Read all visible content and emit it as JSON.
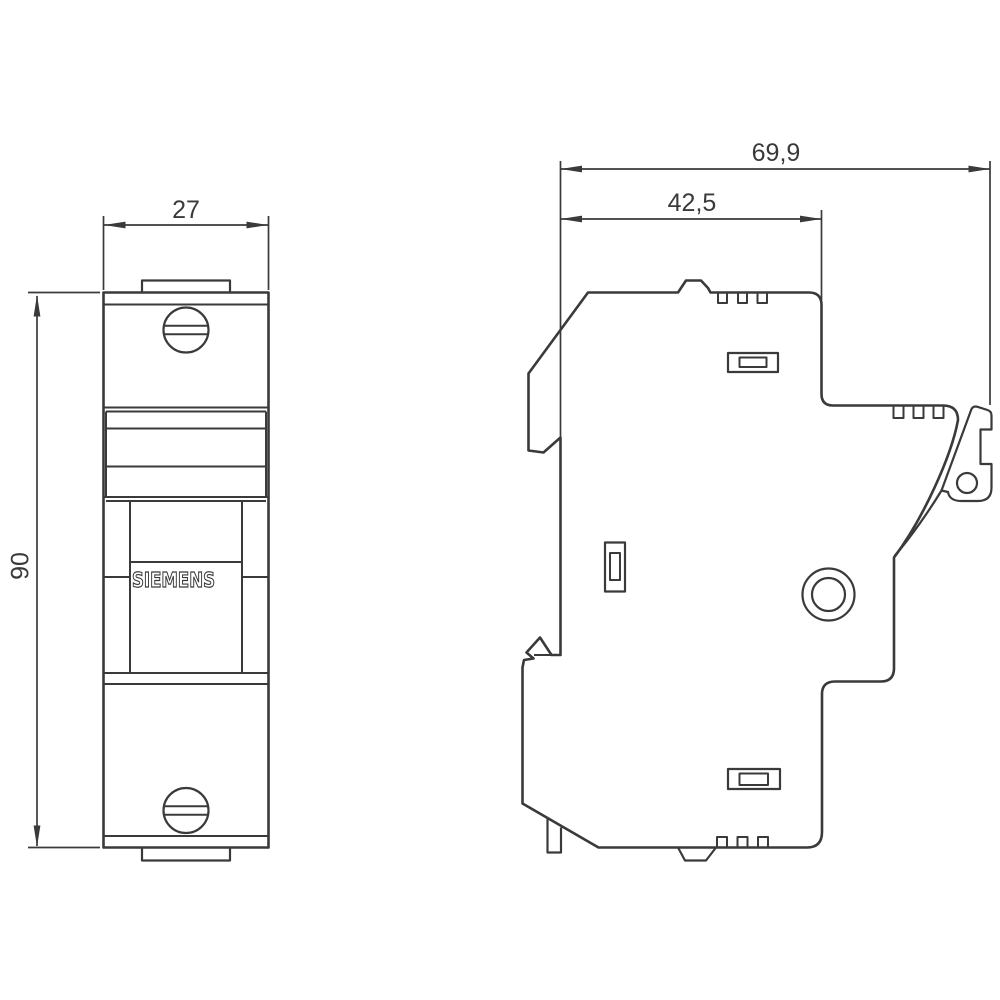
{
  "drawing": {
    "kind": "dimensional technical drawing",
    "brand": "SIEMENS",
    "line_color": "#3a3a3a",
    "background_color": "#ffffff",
    "views": {
      "front": {
        "dimensions": {
          "width": {
            "label": "27"
          },
          "height": {
            "label": "90"
          }
        }
      },
      "side": {
        "dimensions": {
          "total_depth": {
            "label": "69,9"
          },
          "upper_depth": {
            "label": "42,5"
          }
        }
      }
    }
  }
}
